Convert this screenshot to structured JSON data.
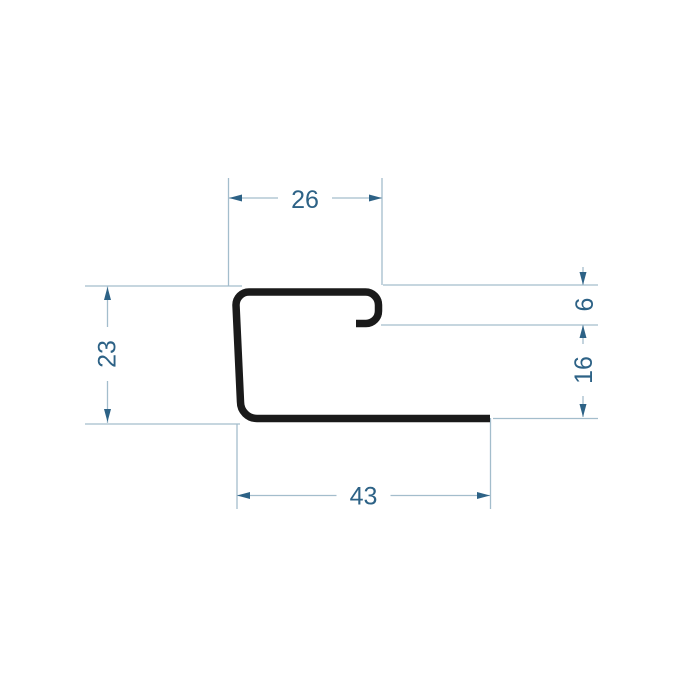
{
  "diagram": {
    "type": "technical-drawing",
    "subject": "metal-profile-cross-section",
    "colors": {
      "background": "#ffffff",
      "profile_stroke": "#1a1a1a",
      "dimension_line": "#a3bdcc",
      "dimension_accent": "#2d6286"
    },
    "dimensions": [
      {
        "id": "top-width",
        "label": "26",
        "orientation": "horizontal"
      },
      {
        "id": "left-height",
        "label": "23",
        "orientation": "vertical"
      },
      {
        "id": "hook-return",
        "label": "6",
        "orientation": "vertical"
      },
      {
        "id": "right-offset",
        "label": "16",
        "orientation": "vertical"
      },
      {
        "id": "bottom-width",
        "label": "43",
        "orientation": "horizontal"
      }
    ]
  }
}
